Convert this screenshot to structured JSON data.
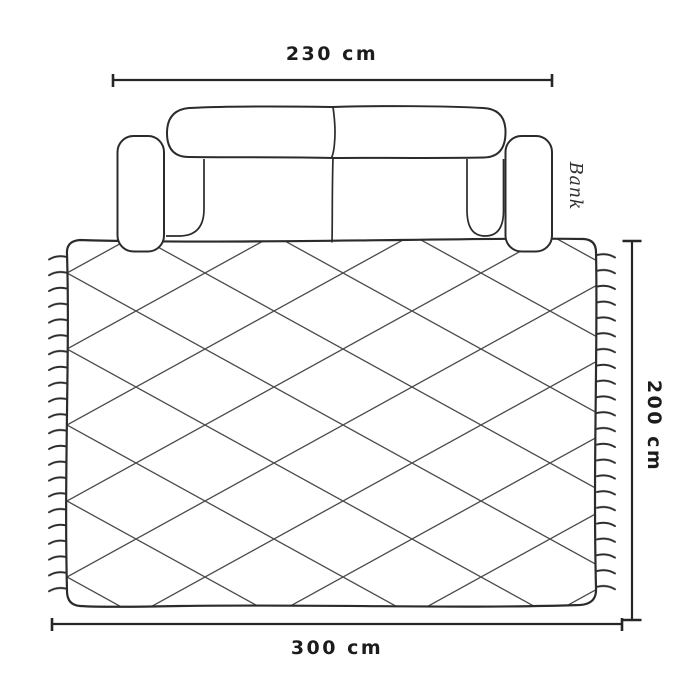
{
  "diagram": {
    "kind": "rug-size-guide",
    "sofa": {
      "label": "Bank",
      "width_label": "230 cm",
      "width_cm": 230
    },
    "rug": {
      "width_label": "300 cm",
      "width_cm": 300,
      "height_label": "200 cm",
      "height_cm": 200,
      "pattern": "diamond-lattice",
      "fringe": "tassel-fringe-left-and-right"
    },
    "colors": {
      "outline": "#2b2b2b",
      "pattern_line": "#4a4a4a",
      "dimension_line": "#262626",
      "label_text": "#1c1c1c",
      "sofa_label_text": "#2f2f2f",
      "background": "#ffffff"
    }
  }
}
